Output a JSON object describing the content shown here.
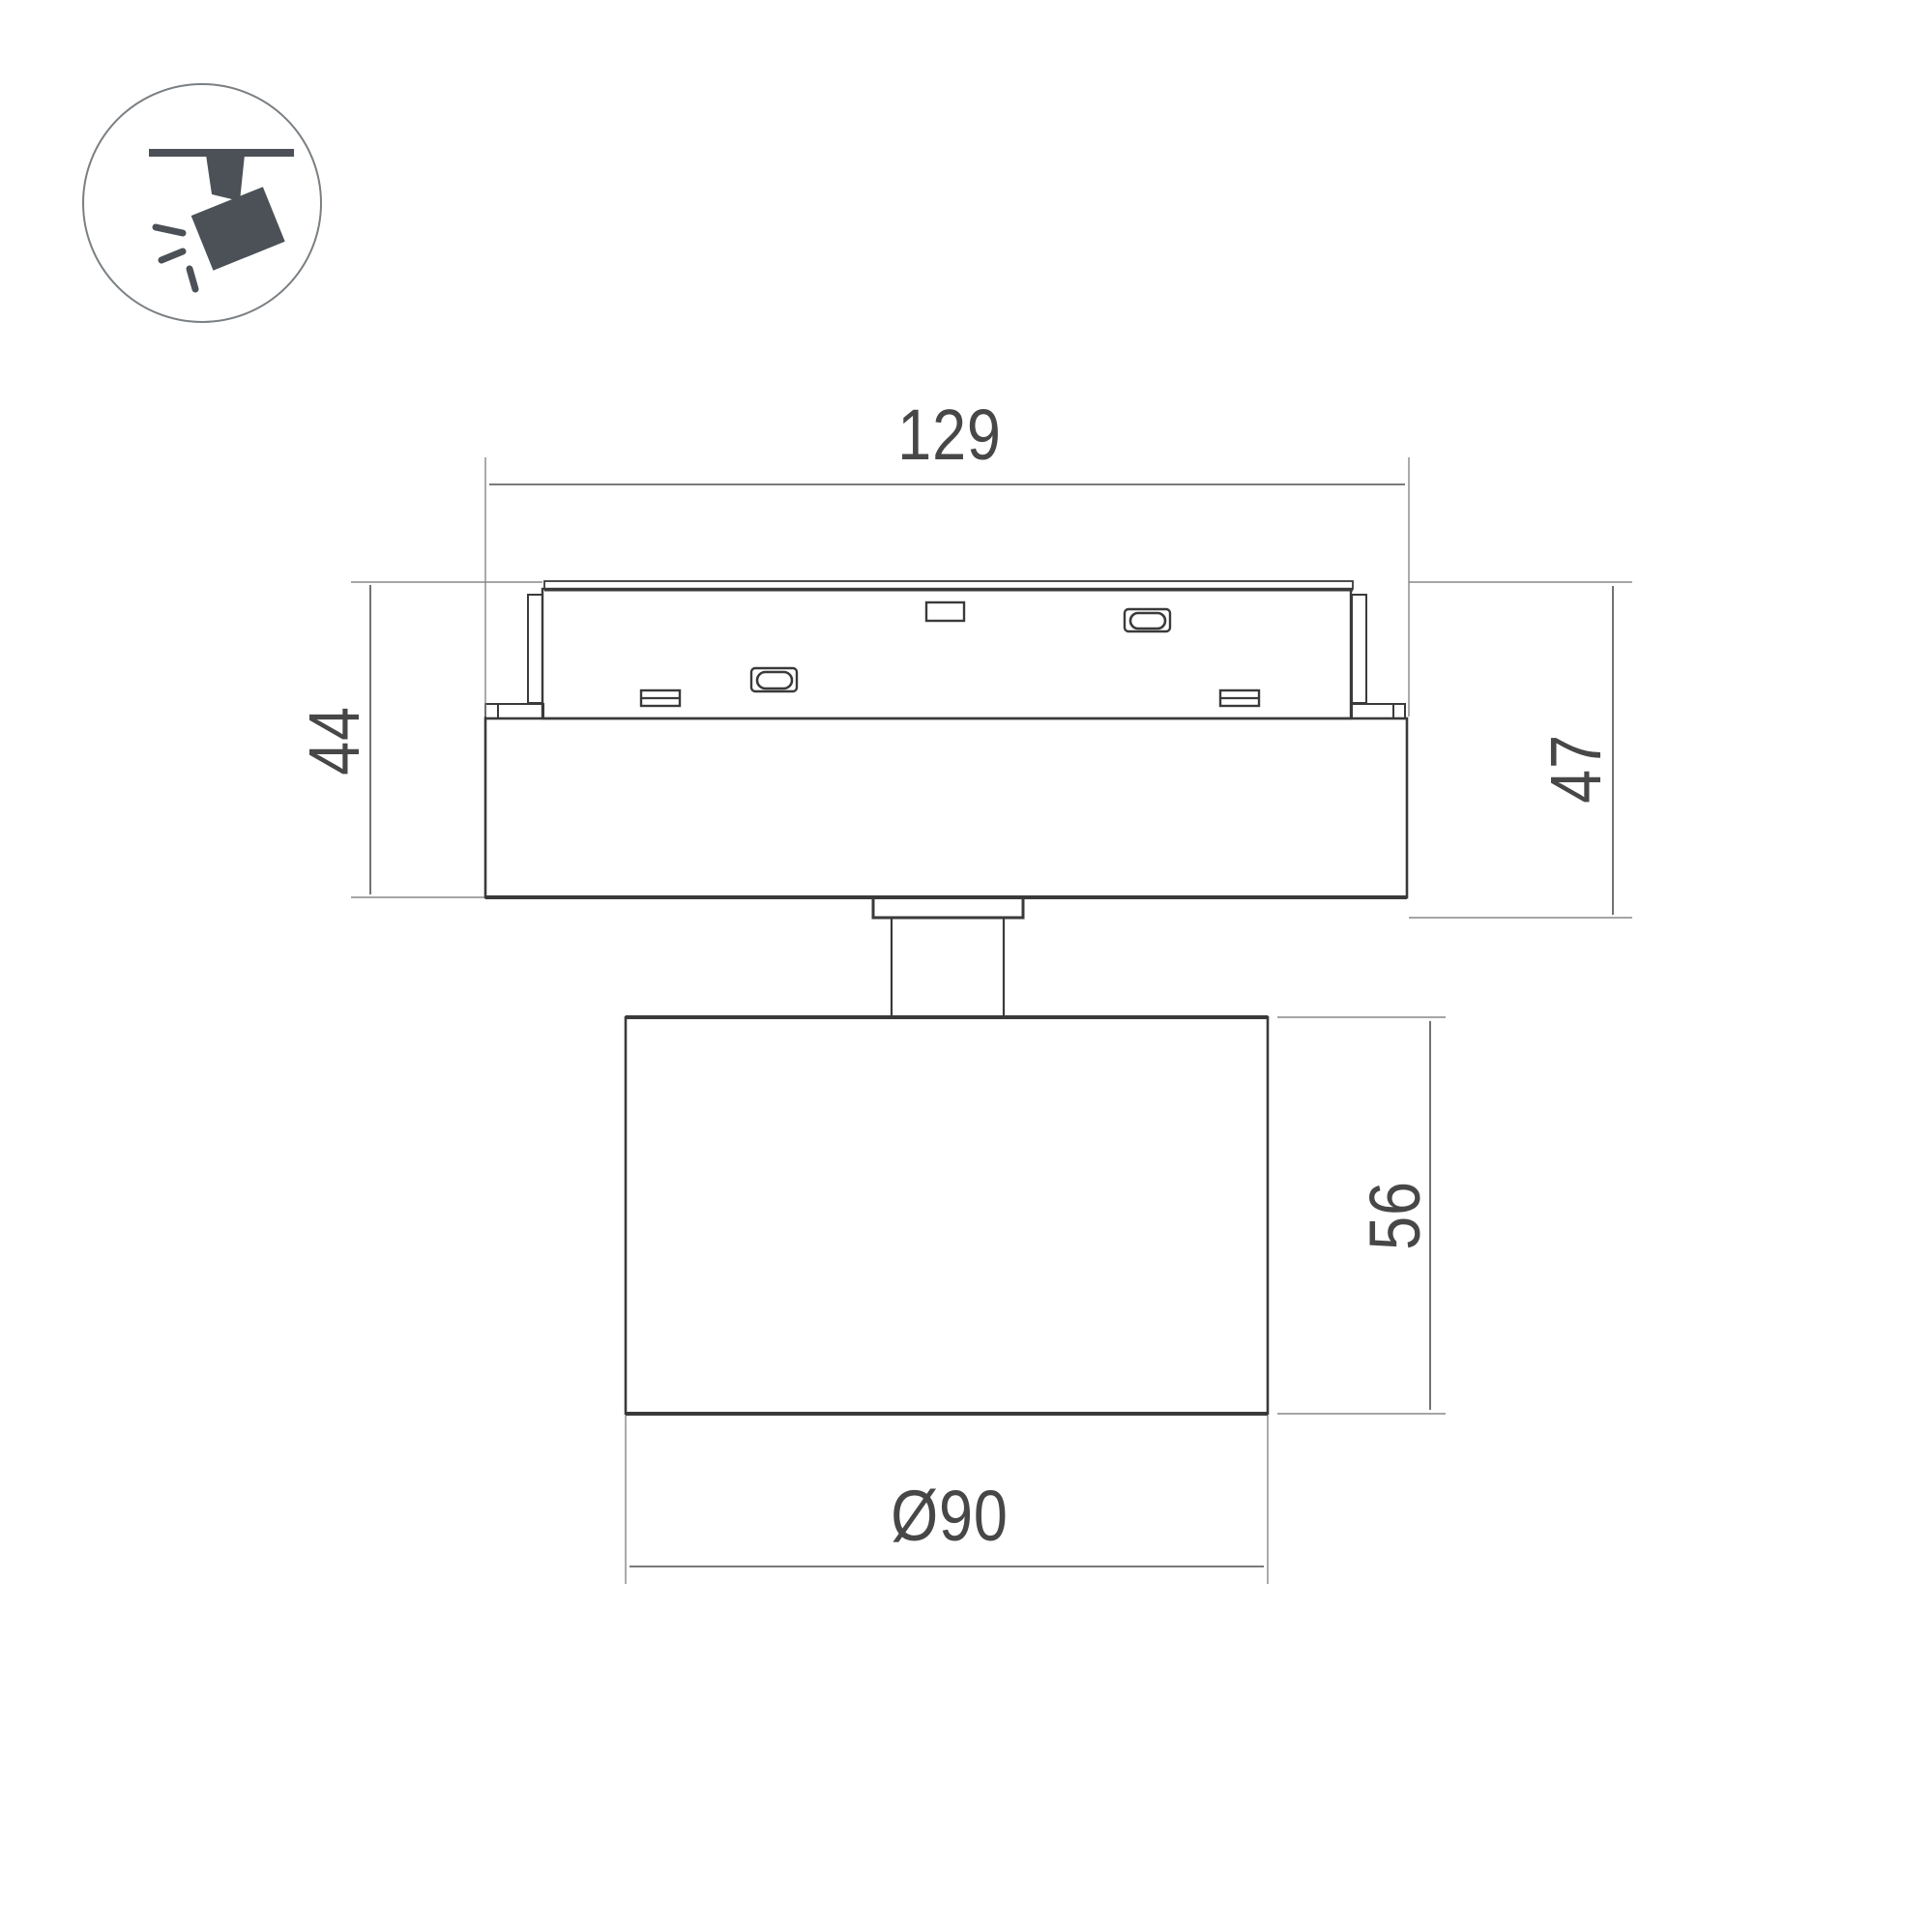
{
  "icon": {
    "semantic": "track-mounted-spotlight-pictogram"
  },
  "drawing": {
    "dimension_labels": {
      "track_adapter_length": "129",
      "adapter_height": "44",
      "overall_drop_height": "47",
      "head_height": "56",
      "head_diameter": "Ø90"
    },
    "colors": {
      "outline": "#3a3a3a",
      "dimension_line": "#4f4f4f",
      "extension_line": "#878787",
      "arrow_fill": "#3f3f3f",
      "label_text": "#474747",
      "icon_glyph": "#4b5157",
      "icon_ring": "#7a7f83",
      "background": "#ffffff"
    }
  }
}
